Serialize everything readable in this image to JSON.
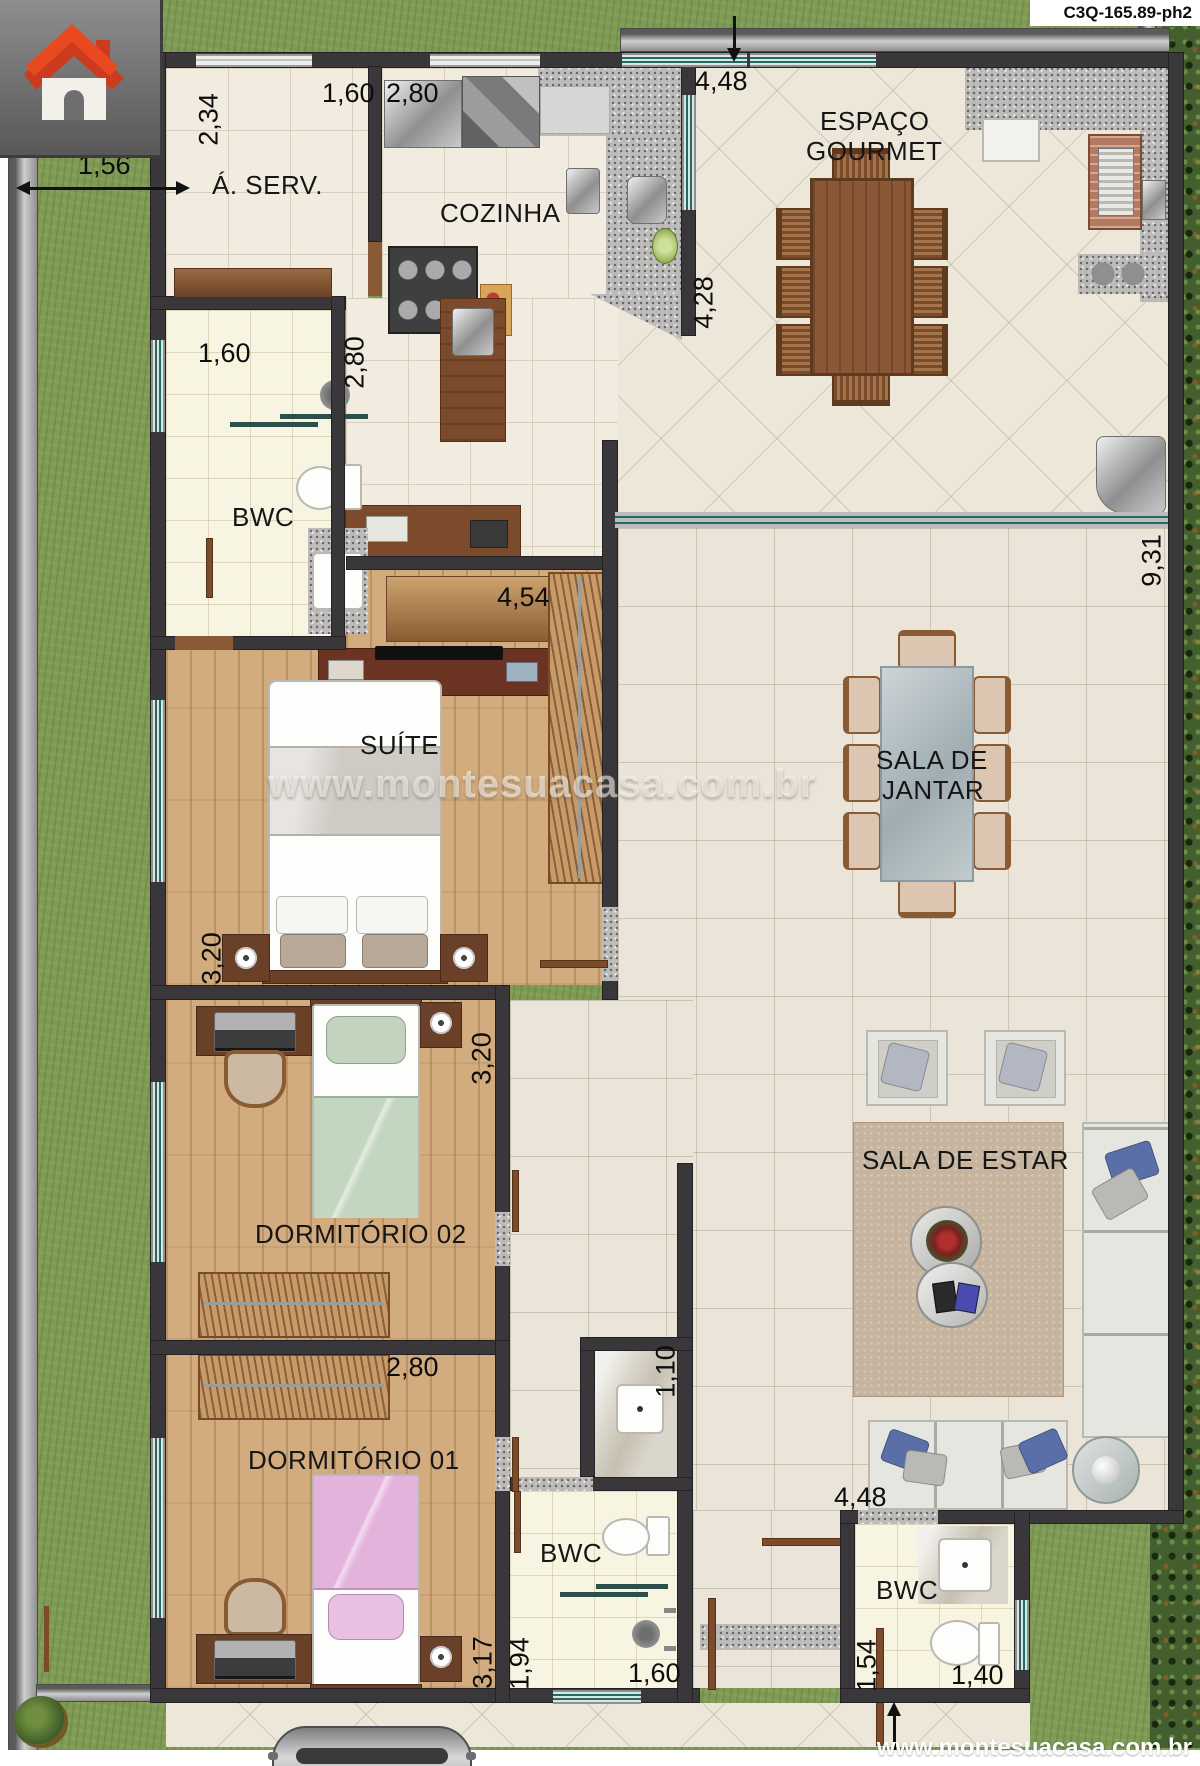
{
  "meta": {
    "plan_code": "C3Q-165.89-ph2",
    "website_footer": "www.montesuacasa.com.br",
    "watermark": "www.montesuacasa.com.br"
  },
  "rooms": {
    "area_servico": "Á. SERV.",
    "cozinha": "COZINHA",
    "espaco_gourmet_l1": "ESPAÇO",
    "espaco_gourmet_l2": "GOURMET",
    "bwc_social": "BWC",
    "suite": "SUÍTE",
    "sala_jantar_l1": "SALA DE",
    "sala_jantar_l2": "JANTAR",
    "dormitorio_02": "DORMITÓRIO 02",
    "sala_estar": "SALA DE ESTAR",
    "dormitorio_01": "DORMITÓRIO 01",
    "bwc_interno": "BWC",
    "bwc_externo": "BWC"
  },
  "dimensions": {
    "aserv_depth": "2,34",
    "aserv_width": "1,60",
    "cozinha_width": "2,80",
    "recuo_lateral": "1,56",
    "gourmet_width": "4,48",
    "gourmet_depth": "4,28",
    "casa_profundidade": "9,31",
    "bwc_social_width": "1,60",
    "bwc_social_depth": "2,80",
    "suite_width": "4,54",
    "suite_depth": "3,20",
    "dorm02_depth": "3,20",
    "dorm01_width": "2,80",
    "dorm01_depth": "3,17",
    "bwc_interno_depth": "1,94",
    "bwc_interno_width": "1,60",
    "bwc_interno_nicho": "1,10",
    "estar_width": "4,48",
    "bwc_externo_depth": "1,54",
    "bwc_externo_width": "1,40"
  }
}
